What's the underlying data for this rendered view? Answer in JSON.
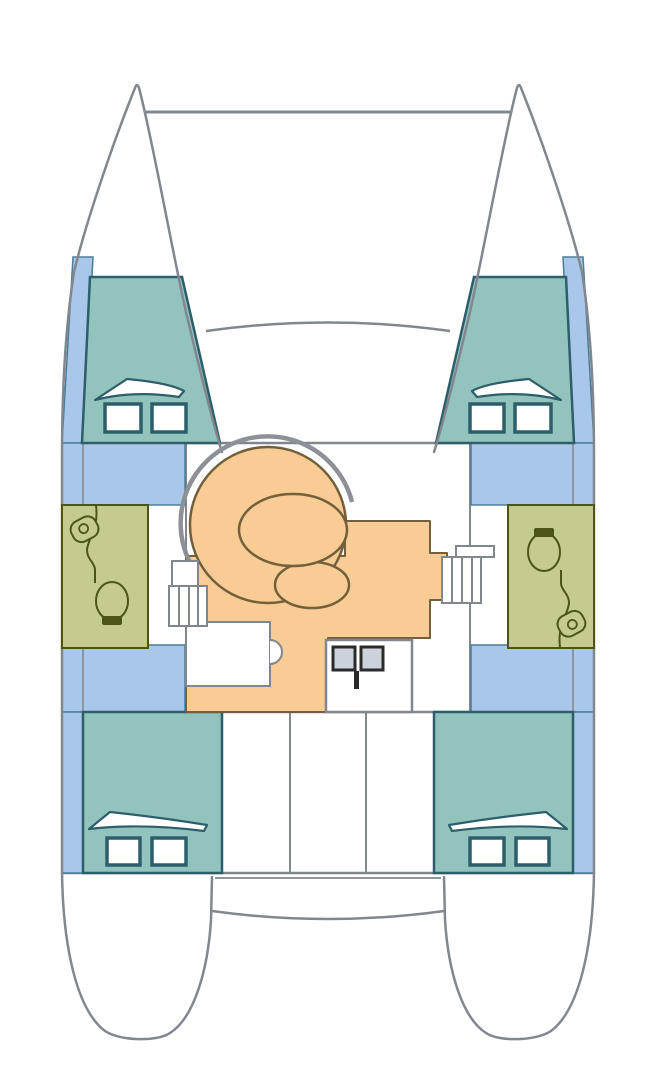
{
  "meta": {
    "title": "Catamaran deck layout plan (top view)",
    "diagram_type": "boat-floor-plan",
    "text_labels": []
  },
  "colors": {
    "hull_line": "#82878e",
    "cabin": "#92c4bd",
    "cabin_line": "#2c5f6b",
    "walkway": "#a9c7e9",
    "walkway_line": "#4a7d9a",
    "bath": "#c7ca8e",
    "bath_line": "#4e5418",
    "salon": "#f9cb95",
    "salon_line": "#73603a",
    "backrest": "#8d9196",
    "sink_fill": "#ccd2d9",
    "fixture_line": "#2a2a2a",
    "background": "#ffffff"
  },
  "regions": [
    {
      "id": "bow-port",
      "type": "bow"
    },
    {
      "id": "bow-starboard",
      "type": "bow"
    },
    {
      "id": "trampoline-beam",
      "type": "crossbeam"
    },
    {
      "id": "forward-cabin-port",
      "type": "cabin",
      "windows": 2,
      "berth_hatch": 1
    },
    {
      "id": "forward-cabin-starboard",
      "type": "cabin",
      "windows": 2,
      "berth_hatch": 1
    },
    {
      "id": "head-port",
      "type": "bathroom",
      "fixtures": [
        "sink",
        "toilet"
      ]
    },
    {
      "id": "head-starboard",
      "type": "bathroom",
      "fixtures": [
        "toilet",
        "sink"
      ]
    },
    {
      "id": "salon",
      "type": "saloon",
      "fixtures": [
        "curved-settee",
        "oval-table",
        "stool-seat",
        "nav-desk",
        "galley-double-sink"
      ]
    },
    {
      "id": "companionway-steps-port",
      "type": "steps"
    },
    {
      "id": "companionway-steps-starboard",
      "type": "steps"
    },
    {
      "id": "side-walkway-port",
      "type": "walkway"
    },
    {
      "id": "side-walkway-starboard",
      "type": "walkway"
    },
    {
      "id": "aft-cabin-port",
      "type": "cabin",
      "windows": 2,
      "berth_hatch": 1
    },
    {
      "id": "aft-cabin-starboard",
      "type": "cabin",
      "windows": 2,
      "berth_hatch": 1
    },
    {
      "id": "cockpit",
      "type": "cockpit"
    },
    {
      "id": "transom-port",
      "type": "stern"
    },
    {
      "id": "transom-starboard",
      "type": "stern"
    }
  ],
  "counts": {
    "cabins": 4,
    "heads": 2,
    "hull_windows": 8,
    "berth_hatches": 4
  }
}
